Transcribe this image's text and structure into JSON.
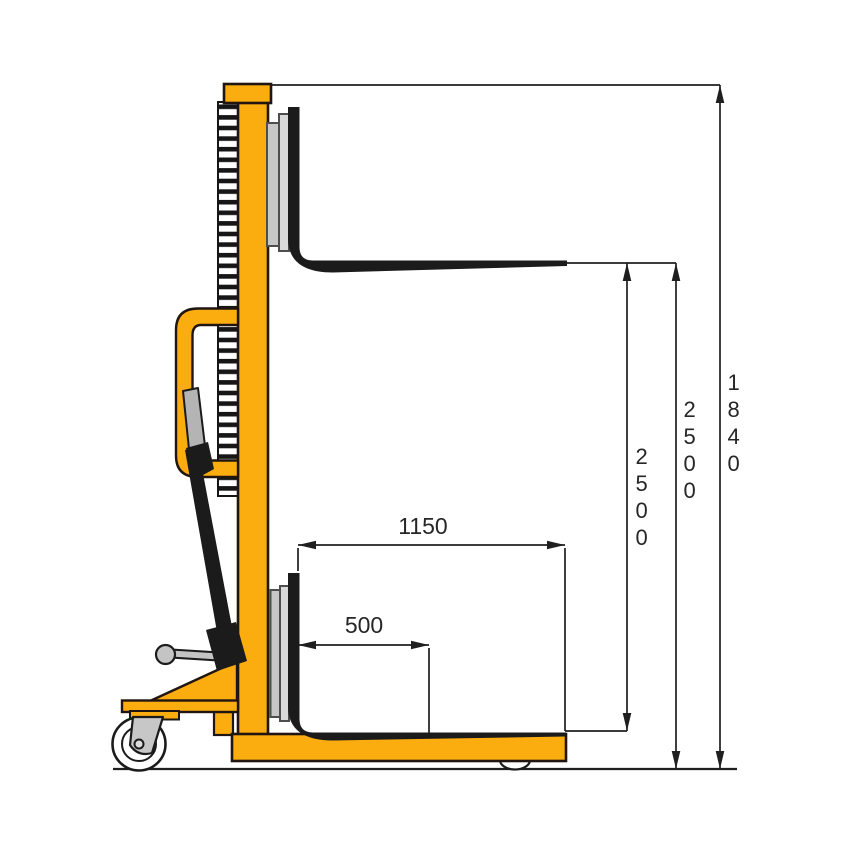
{
  "diagram": {
    "subject": "pallet stacker side view",
    "dimensions": {
      "fork_length": {
        "value": "1150"
      },
      "load_center": {
        "value": "500"
      },
      "lift_height": {
        "value": "2500"
      },
      "overall_lift": {
        "value": "2500"
      },
      "mast_height": {
        "value": "1840"
      }
    },
    "colors": {
      "machine_yellow": "#FBAC0F",
      "outline_dark": "#201510",
      "fork_black": "#1B1B1B",
      "steel_gray": "#C7C7C7",
      "steel_gray_light": "#D9D9D9",
      "dimension_line": "#1F1F1F",
      "background": "#FFFFFF"
    }
  }
}
